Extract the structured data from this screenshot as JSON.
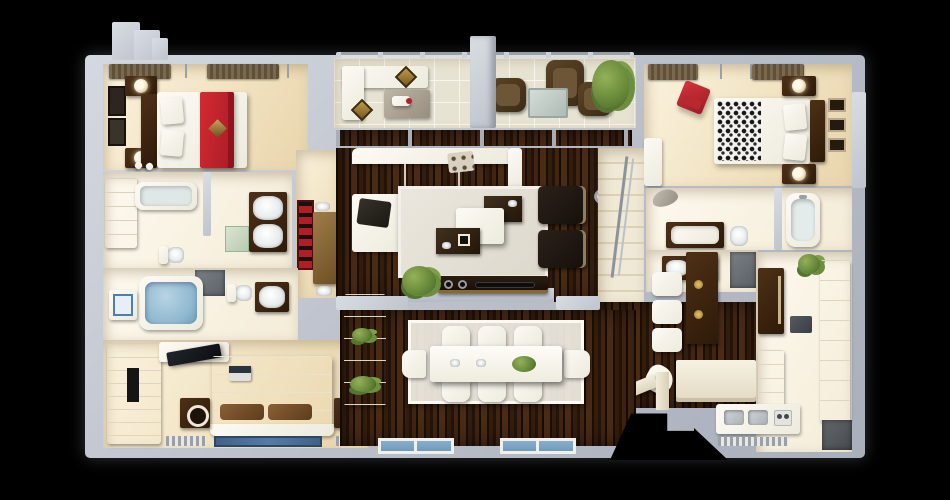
{
  "title": "3D Apartment Floor Plan (Top-Down Render)",
  "palette": {
    "background": "#000000",
    "wall_gray": "#bfc4cd",
    "floor_beige": "#f0e1c2",
    "hardwood_dark": "#2a1708",
    "white_furniture": "#f6f3ea",
    "dark_wood_furniture": "#422812",
    "accent_red": "#c3242e",
    "water_blue": "#8fb8d0",
    "rug_blue": "#4a6f96",
    "balcony_tile": "#e7e3d2",
    "plant_green": "#6b8f3e",
    "shower_gray": "#6e7378"
  },
  "rooms": [
    {
      "id": "bedroom-top-left",
      "name": "Bedroom 1 — bed with red runner, nightstand lamps, wall art, curtained window"
    },
    {
      "id": "balcony",
      "name": "Balcony — wicker chairs, outdoor sofa, low table, potted plant, glass railing"
    },
    {
      "id": "bedroom-top-right",
      "name": "Bedroom 2 — bed with damask throw, red chair, nightstands, picture frames"
    },
    {
      "id": "bathroom-upper-left",
      "name": "Bathroom & closet — bathtub, shelving, double vanity, shower, toilet"
    },
    {
      "id": "bathroom-lower-left",
      "name": "Bathroom — soaking tub with water, bath mat, toilet, vanity"
    },
    {
      "id": "master-bedroom",
      "name": "Master bedroom — bed with laptop, wardrobe with TV, speakers, blue rug"
    },
    {
      "id": "living-room",
      "name": "Living room — sectional sofa, coffee tables, two armchairs, media console, rug"
    },
    {
      "id": "dining-room",
      "name": "Dining room — eight-seat table with centerpiece, sideboard with plants"
    },
    {
      "id": "kitchen",
      "name": "Kitchen — fridge, cabinets, microwave, double sink, breakfast bar with stools"
    },
    {
      "id": "bathroom-right",
      "name": "Bathroom — soaker tub, tub with surround, toilet, double vanity, pendant lamp"
    },
    {
      "id": "stair-hall",
      "name": "Stair hall — staircase with metal railing"
    },
    {
      "id": "entry",
      "name": "Entry vestibule — desk nook with chair"
    },
    {
      "id": "utility",
      "name": "Utility corner — appliance counter and mats"
    },
    {
      "id": "corridor-nook",
      "name": "Hall nook — red artwork and wooden console"
    }
  ],
  "furniture_labels": {
    "bed": "bed",
    "sofa": "sofa",
    "armchair": "armchair",
    "dining_table": "dining table",
    "stool": "bar stool",
    "tub": "bathtub",
    "toilet": "toilet",
    "sink": "sink",
    "shower": "shower",
    "tv": "television",
    "speaker": "speaker",
    "rug": "rug",
    "plant": "plant",
    "lamp": "lamp",
    "window": "window",
    "mirror": "wall mirror"
  }
}
